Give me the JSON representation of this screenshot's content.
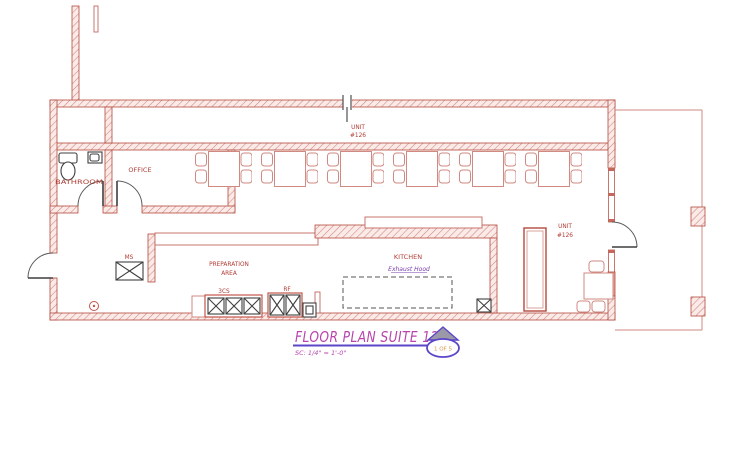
{
  "drawing": {
    "title": "FLOOR PLAN SUITE 126",
    "scale_note": "SC: 1/4\" = 1'-0\"",
    "title_bubble": "1 OF 5",
    "labels": {
      "bathroom": "BATHROOM",
      "office": "OFFICE",
      "kitchen": "KITCHEN",
      "prep_1": "PREPARATION",
      "prep_2": "AREA",
      "unit_top_1": "UNIT",
      "unit_top_2": "#126",
      "unit_right_1": "UNIT",
      "unit_right_2": "#126",
      "exhaust_hood": "Exhaust Hood",
      "ms": "MS",
      "cs3": "3CS",
      "rf": "RF"
    },
    "colors": {
      "wall_stroke": "#b5493d",
      "wall_hatch": "#d4837b",
      "furniture_red": "#d08a82",
      "label_red": "#b23c34",
      "title_magenta": "#b844ac",
      "accent_blue": "#5a46c8",
      "hood_purple": "#7b3fb0",
      "bubble_orange": "#d89b42",
      "triangle_gray": "#9b98a8",
      "door_dark": "#3f3f3f"
    }
  }
}
